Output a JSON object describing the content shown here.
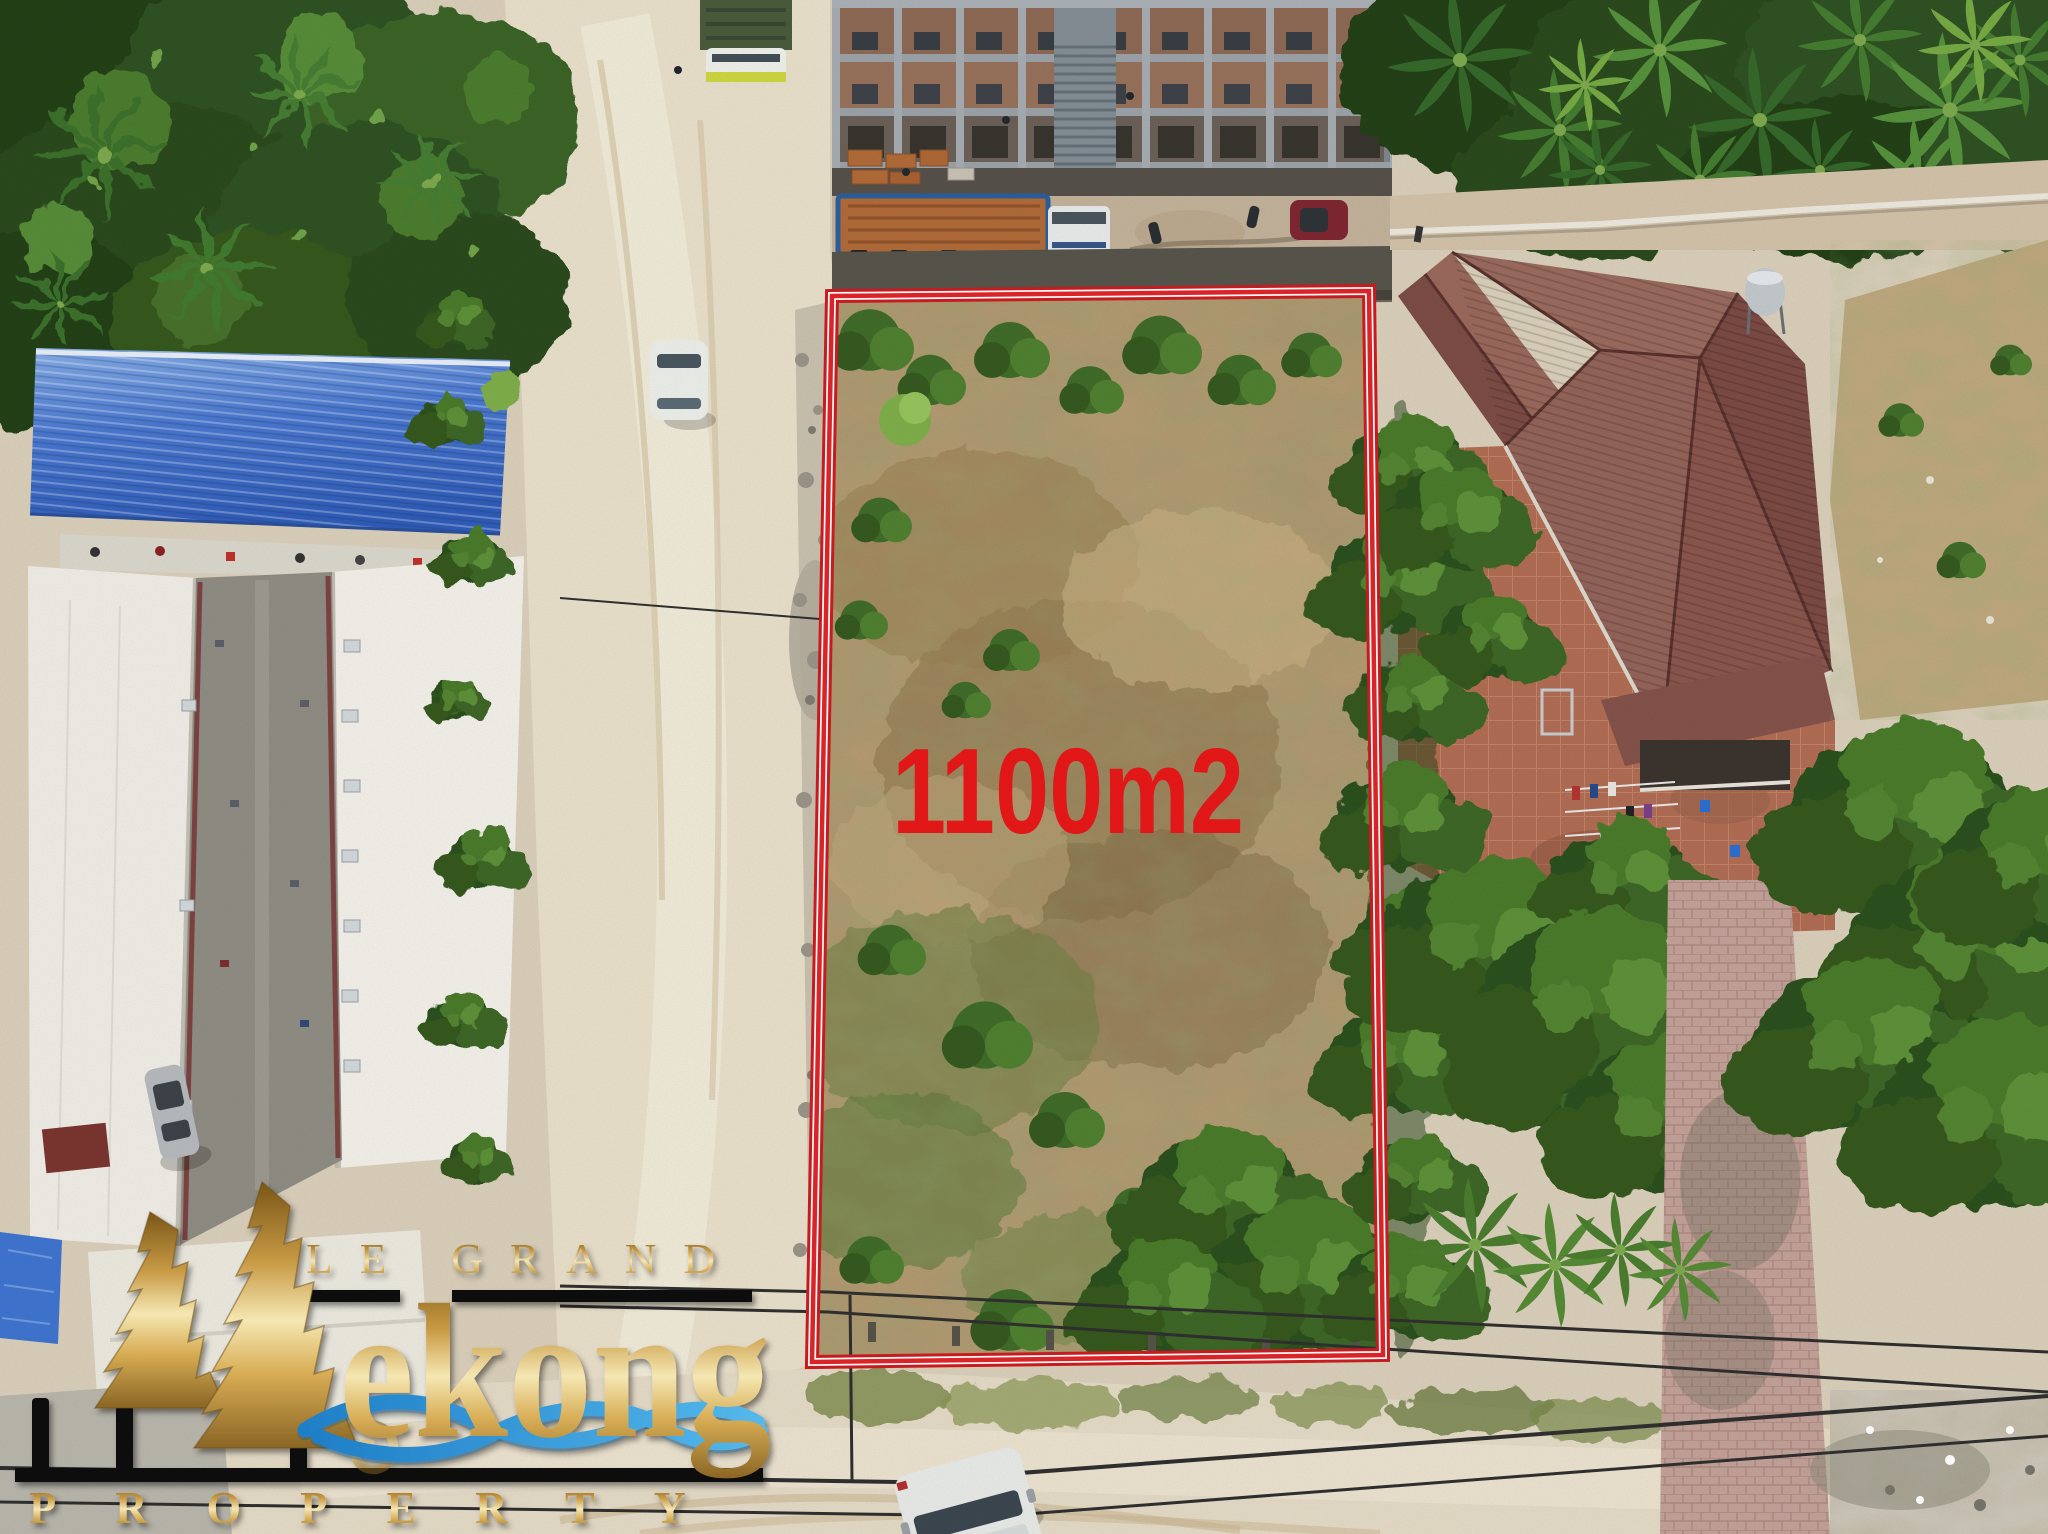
{
  "scene": {
    "area_label": "1100m2",
    "area_label_color": "#e81717",
    "boundary_color": "#cc1b20",
    "boundary_gap_color": "#ffffff",
    "boundary_inner_color": "#e02428"
  },
  "watermark": {
    "top_line": "LE GRAND",
    "brand_word": "ekong",
    "bottom_line": "PROPERTY",
    "gold_hex": "#d2a64e",
    "wave_blue_hex": "#2f97d8",
    "bar_black_hex": "#0b0b0b"
  }
}
